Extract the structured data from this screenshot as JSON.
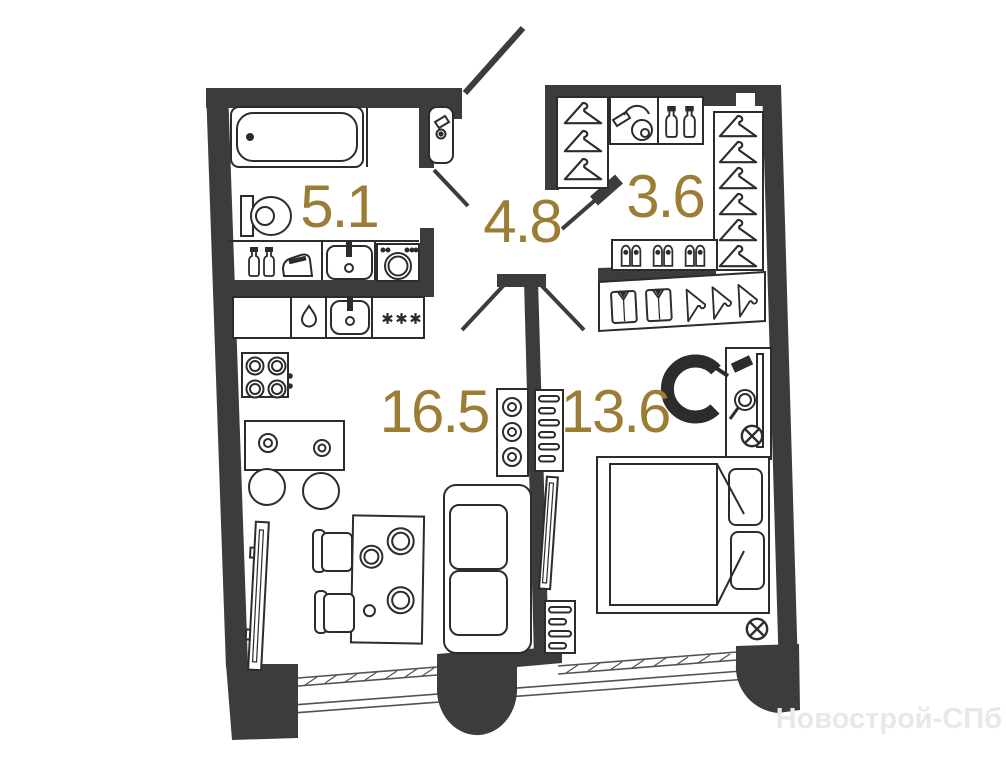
{
  "plan": {
    "rooms": [
      {
        "id": "bathroom",
        "area": "5.1",
        "icons": [
          "bathtub-icon",
          "toilet-icon",
          "washbasin-icon",
          "washing-machine-icon",
          "iron-icon",
          "bottles-icon"
        ]
      },
      {
        "id": "hallway",
        "area": "4.8",
        "icons": [
          "entrance-door-swing",
          "corner-basin-icon",
          "door-swing"
        ]
      },
      {
        "id": "wardrobe",
        "area": "3.6",
        "icons": [
          "hanger-icon",
          "vacuum-cleaner-icon",
          "bottles-icon",
          "shoes-icon"
        ]
      },
      {
        "id": "living-kitchen",
        "area": "16.5",
        "icons": [
          "stove-icon",
          "kitchen-sink-icon",
          "dishwasher-icon",
          "hob-icon",
          "dining-table-icon",
          "chair-icon",
          "stool-icon",
          "sofa-icon",
          "tv-icon",
          "shelf-icon"
        ]
      },
      {
        "id": "bedroom",
        "area": "13.6",
        "icons": [
          "double-bed-icon",
          "pillow-icon",
          "shirt-icon",
          "hanger-icon",
          "vanity-table-icon",
          "mirror-icon",
          "armchair-icon",
          "radiator-icon",
          "tv-icon",
          "outlet-icon"
        ]
      }
    ],
    "watermark": "Новострой-СПб",
    "colors": {
      "wall": "#3e3c3a",
      "line": "#2e2c2a",
      "area_label": "#9c7d36",
      "watermark": "#eae8e4",
      "background": "#ffffff"
    }
  }
}
